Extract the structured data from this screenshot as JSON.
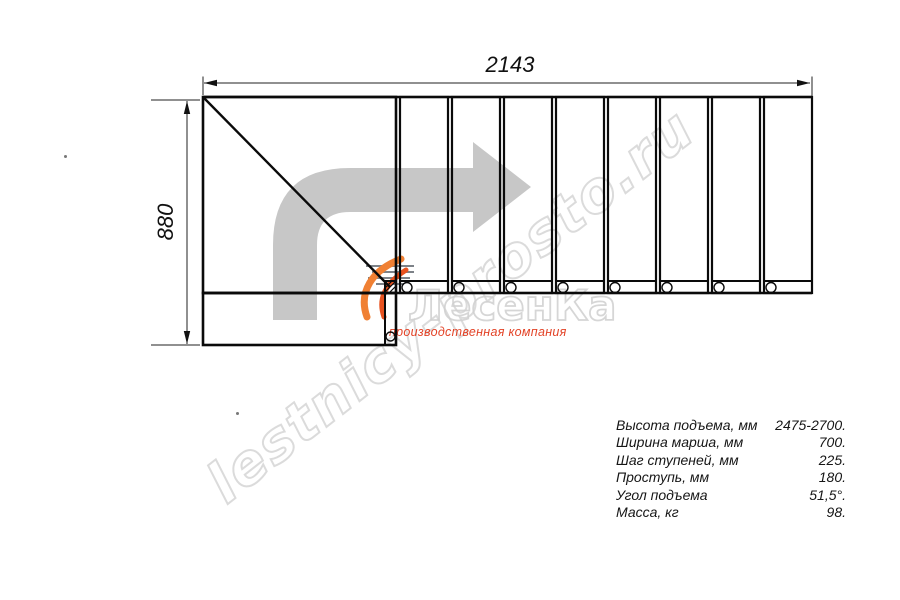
{
  "drawing": {
    "title": "staircase-plan-view",
    "dim_width_label": "2143",
    "dim_height_label": "880"
  },
  "specs": {
    "rows": [
      {
        "label": "Высота подъема, мм",
        "value": "2475-2700."
      },
      {
        "label": "Ширина марша, мм",
        "value": "700."
      },
      {
        "label": "Шаг ступеней, мм",
        "value": "225."
      },
      {
        "label": "Проступь, мм",
        "value": "180."
      },
      {
        "label": "Угол подъема",
        "value": "51,5°."
      },
      {
        "label": "Масса, кг",
        "value": "98."
      }
    ]
  },
  "watermark": {
    "url_text": "lestnicy-prosto.ru",
    "logo_text": "ЛесенКа",
    "slogan": "производственная компания"
  },
  "colors": {
    "line": "#0a0a0a",
    "dimension": "#222222",
    "arrow_gray": "#c7c7c7",
    "watermark_gray": "#c4c4c4",
    "logo_outline": "#d0d0d0",
    "flame_orange": "#f08033",
    "flame_red": "#e8521f",
    "slogan_red": "#e34327"
  }
}
